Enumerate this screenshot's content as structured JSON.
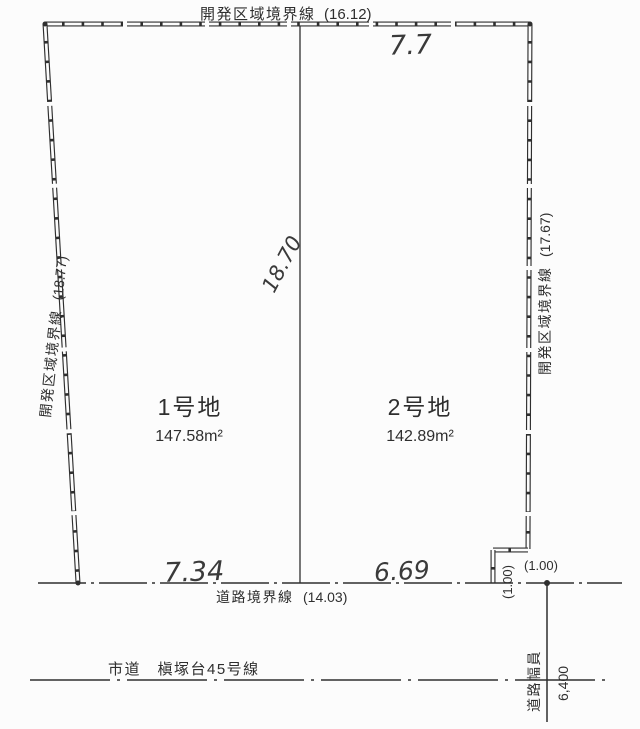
{
  "colors": {
    "ink": "#2f2f2f",
    "paper": "#fcfcfc"
  },
  "boundary_labels": {
    "top": {
      "name": "開発区域境界線",
      "length": "(16.12)"
    },
    "left": {
      "name": "開発区域境界線",
      "length": "(18.77)"
    },
    "right": {
      "name": "開発区域境界線",
      "length": "(17.67)"
    }
  },
  "plots": [
    {
      "name": "1号地",
      "area": "147.58m²"
    },
    {
      "name": "2号地",
      "area": "142.89m²"
    }
  ],
  "dimensions": {
    "top_partial": "7.7",
    "center_depth": "18.70",
    "frontage_plot1": "7.34",
    "frontage_plot2": "6.69",
    "step_horizontal": "(1.00)",
    "step_vertical": "(1.00)"
  },
  "road": {
    "boundary_label": "道路境界線",
    "boundary_length": "(14.03)",
    "name": "市道　槇塚台45号線",
    "width_label": "道路幅員",
    "width_value": "6,400"
  }
}
